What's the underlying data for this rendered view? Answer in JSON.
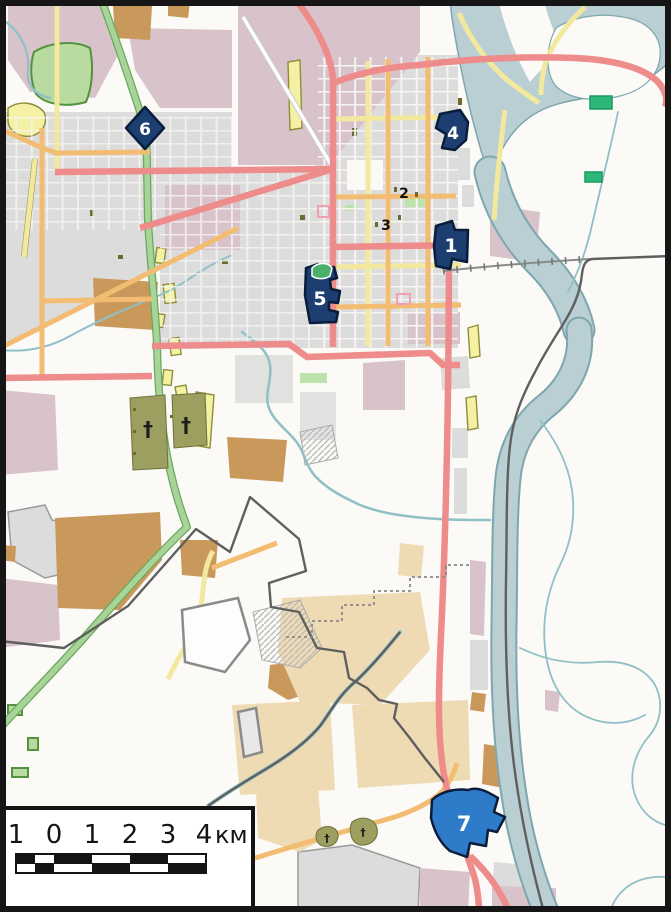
{
  "map": {
    "markers": [
      {
        "id": "1",
        "label": "1",
        "style": "filled-polygon"
      },
      {
        "id": "2",
        "label": "2",
        "style": "small-number"
      },
      {
        "id": "3",
        "label": "3",
        "style": "small-number"
      },
      {
        "id": "4",
        "label": "4",
        "style": "filled-polygon"
      },
      {
        "id": "5",
        "label": "5",
        "style": "filled-polygon"
      },
      {
        "id": "6",
        "label": "6",
        "style": "filled-diamond"
      },
      {
        "id": "7",
        "label": "7",
        "style": "filled-polygon"
      }
    ],
    "symbols": {
      "cemetery_cross": "†"
    }
  },
  "scale_bar": {
    "tick_labels": [
      "1",
      "0",
      "1",
      "2",
      "3",
      "4"
    ],
    "unit_label": "км"
  },
  "colors": {
    "land": "#fbfaf7",
    "urban_gray": "#dcdcdc",
    "mauve": "#d8c3cb",
    "brown_field": "#c9995c",
    "tan_field": "#eedbb4",
    "yellow_area": "#f4f0a4",
    "yellow_outline": "#8e8e3a",
    "olive_area": "#9d9f60",
    "park_green": "#b9dba0",
    "park_outline": "#55923f",
    "bright_green": "#2db878",
    "water_fill": "#b9cfd3",
    "water_stroke": "#7da6ad",
    "stream": "#8fc0c6",
    "road_red": "#ee8b8b",
    "road_orange": "#f2bd72",
    "road_yellow": "#f2e99e",
    "road_green": "#a8d499",
    "road_green_casing": "#6aa85c",
    "road_casing": "#c9c9c9",
    "railway": "#8a8a8a",
    "boundary": "#5f5f5f",
    "marker_fill": "#1c3e70",
    "marker_stroke": "#0a1d3a",
    "marker7_fill": "#2e7cc9",
    "marker_text": "#ffffff",
    "small_marker_text": "#111111",
    "scalebar_bg": "#ffffff",
    "scalebar_border": "#141414",
    "scalebar_text": "#141414"
  }
}
